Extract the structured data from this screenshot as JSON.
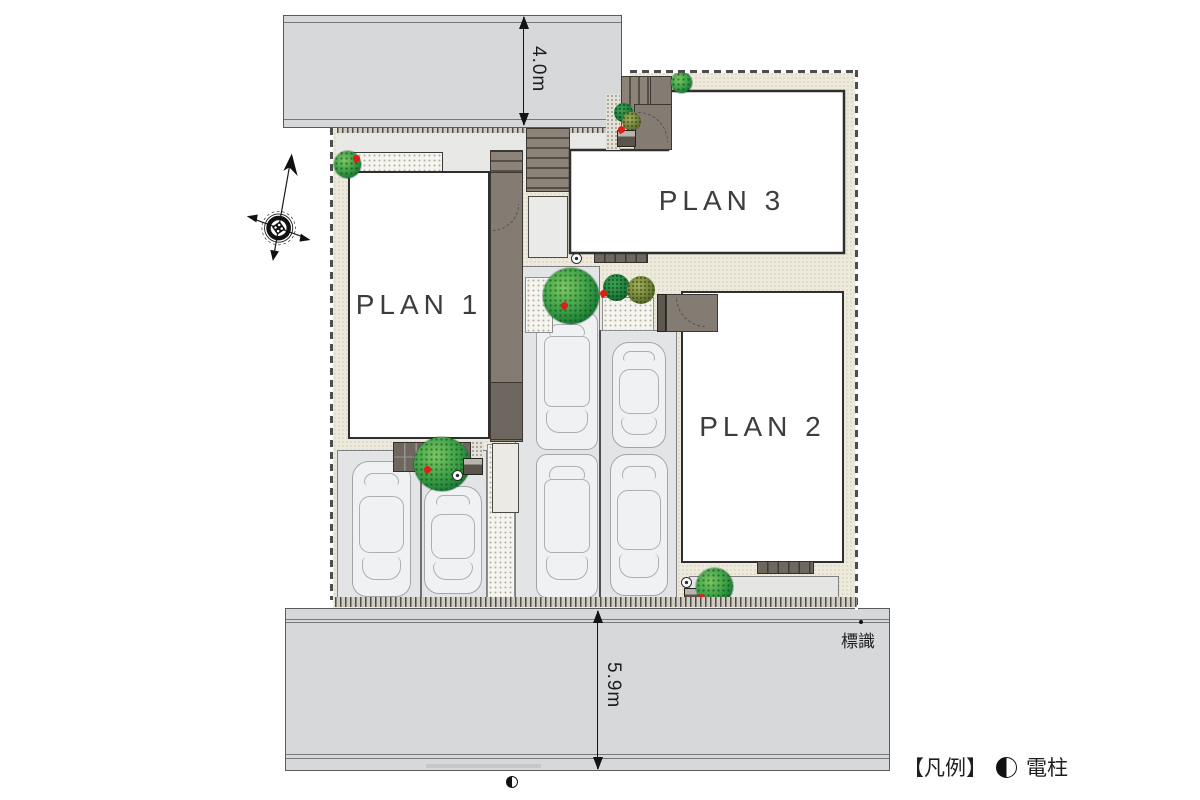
{
  "site_plan": {
    "plans": [
      {
        "label": "PLAN 1"
      },
      {
        "label": "PLAN 2"
      },
      {
        "label": "PLAN 3"
      }
    ],
    "dimensions": {
      "top_road_width": "4.0m",
      "bottom_road_width": "5.9m"
    },
    "road_labels": {
      "sign": "標識"
    },
    "legend": {
      "bracket": "【凡例】",
      "pole_label": "電柱",
      "pole_symbol": "left-half-filled-circle"
    },
    "colors": {
      "road": "#d7d8d9",
      "site_ground": "#edeadd",
      "building_fill": "#ffffff",
      "building_outline": "#2f2f2f",
      "approach": "#847c72",
      "tree_green": "#2f9140",
      "accent_red": "#dd1f17"
    }
  }
}
